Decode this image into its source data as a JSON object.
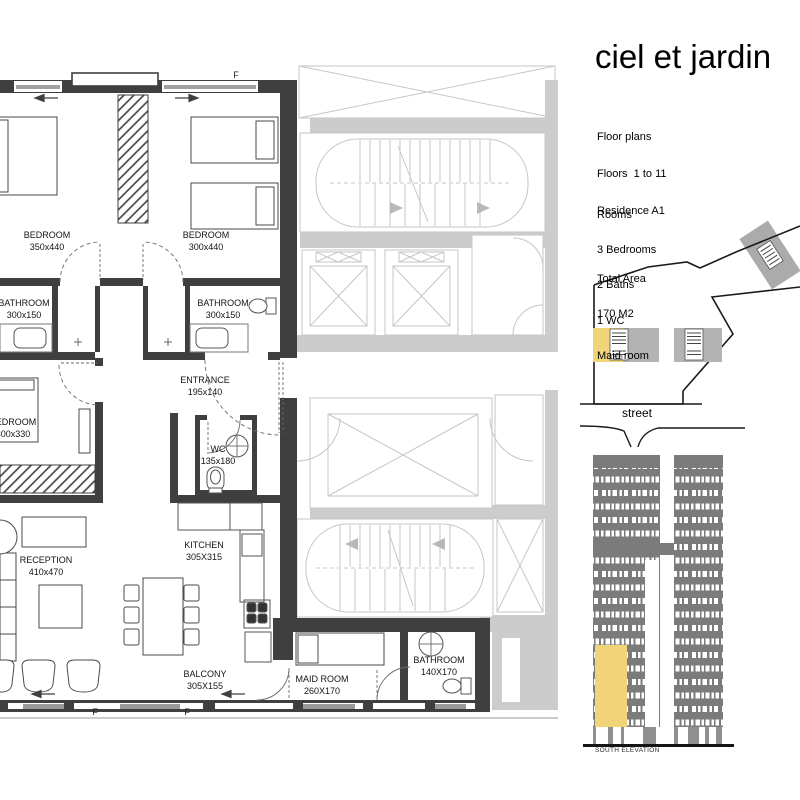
{
  "header": {
    "title": "ciel et jardin"
  },
  "project_info": {
    "lines": [
      "Floor plans",
      "Floors  1 to 11",
      "Residence A1"
    ]
  },
  "program": {
    "heading": "Rooms",
    "items": [
      "3 Bedrooms",
      "2 Baths",
      "1 WC",
      "Maid room"
    ],
    "total_label": "Total Area",
    "total_value": "170 M2"
  },
  "site_plan": {
    "street_label": "street"
  },
  "elevation": {
    "caption": "SOUTH ELEVATION"
  },
  "floor_plan": {
    "labels": [
      {
        "name": "BEDROOM",
        "dims": "350x440"
      },
      {
        "name": "BEDROOM",
        "dims": "300x440"
      },
      {
        "name": "BATHROOM",
        "dims": "300x150"
      },
      {
        "name": "BATHROOM",
        "dims": "300x150"
      },
      {
        "name": "ENTRANCE",
        "dims": "195x140"
      },
      {
        "name": "BEDROOM",
        "dims": "300x330"
      },
      {
        "name": "WC",
        "dims": "135x180"
      },
      {
        "name": "KITCHEN",
        "dims": "305X315"
      },
      {
        "name": "RECEPTION",
        "dims": "410x470"
      },
      {
        "name": "BALCONY",
        "dims": "305X155"
      },
      {
        "name": "MAID ROOM",
        "dims": "260X170"
      },
      {
        "name": "BATHROOM",
        "dims": "140X170"
      }
    ],
    "window_tags": {
      "top": "F",
      "bottom_left": "F",
      "bottom_right": "F"
    }
  },
  "colors": {
    "highlight_yellow": "#F2D478",
    "tower_gray": "#7B7B7B",
    "core_gray": "#CBCBCB",
    "wall_dark": "#3F3F3F"
  }
}
